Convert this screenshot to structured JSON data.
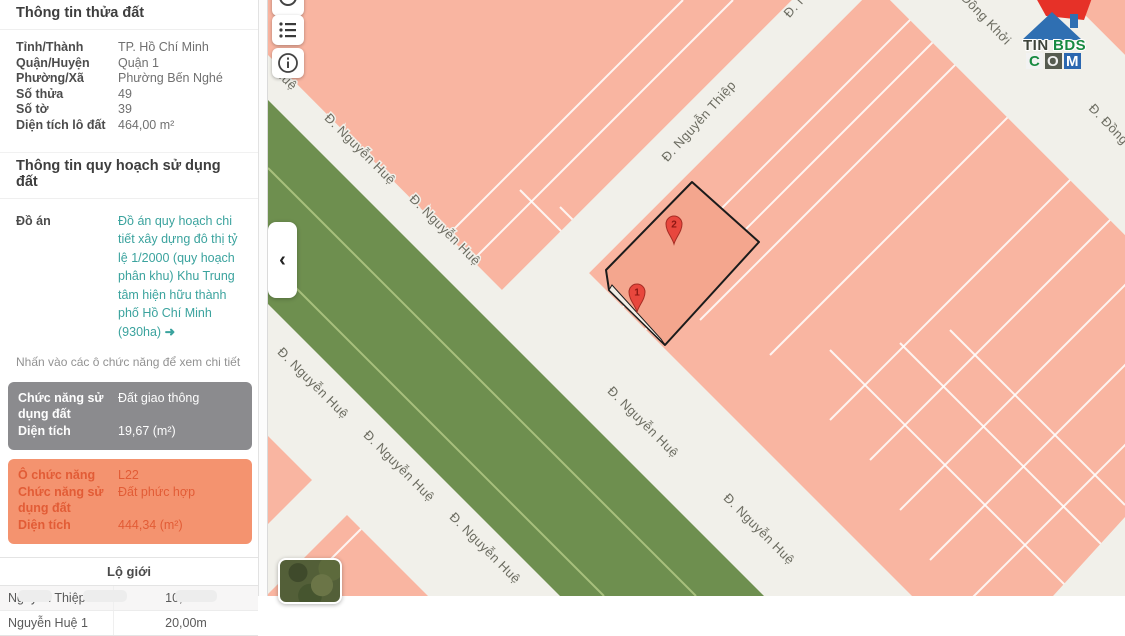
{
  "sidebar": {
    "section1_title": "Thông tin thửa đất",
    "fields": [
      {
        "label": "Tỉnh/Thành",
        "value": "TP. Hồ Chí Minh"
      },
      {
        "label": "Quận/Huyện",
        "value": "Quận 1"
      },
      {
        "label": "Phường/Xã",
        "value": "Phường Bến Nghé"
      },
      {
        "label": "Số thửa",
        "value": "49"
      },
      {
        "label": "Số tờ",
        "value": "39"
      },
      {
        "label": "Diện tích lô đất",
        "value": "464,00 m²"
      }
    ],
    "section2_title": "Thông tin quy hoạch sử dụng đất",
    "do_an_label": "Đồ án",
    "do_an_link": "Đồ án quy hoạch chi tiết xây dựng đô thị tỷ lệ 1/2000 (quy hoạch phân khu) Khu Trung tâm hiện hữu thành phố Hồ Chí Minh (930ha)",
    "do_an_arrow": "➜",
    "note": "Nhấn vào các ô chức năng để xem chi tiết",
    "gray_card": {
      "rows": [
        {
          "label": "Chức năng sử dụng đất",
          "value": "Đất giao thông"
        },
        {
          "label": "Diện tích",
          "value": "19,67 (m²)"
        }
      ]
    },
    "orange_card": {
      "rows": [
        {
          "label": "Ô chức năng",
          "value": "L22"
        },
        {
          "label": "Chức năng sử dụng đất",
          "value": "Đất phức hợp"
        },
        {
          "label": "Diện tích",
          "value": "444,34 (m²)"
        }
      ]
    },
    "road_table": {
      "title": "Lộ giới",
      "rows": [
        {
          "name": "Nguyễn Thiệp",
          "width": "10,00m"
        },
        {
          "name": "Nguyễn Huệ 1",
          "width": "20,00m"
        }
      ]
    }
  },
  "map": {
    "toolbar": [
      {
        "icon": "circle-icon"
      },
      {
        "icon": "list-icon"
      },
      {
        "icon": "info-icon"
      }
    ],
    "collapse_chevron": "‹",
    "labels": [
      {
        "text": "Huệ"
      },
      {
        "text": "Đ. Nguyễn Huệ"
      },
      {
        "text": "Đ. Nguyễn Huệ"
      },
      {
        "text": "Đ. Nguyễn Huệ"
      },
      {
        "text": "Đ. Nguyễn Huệ"
      },
      {
        "text": "Đ. Nguyễn Huệ"
      },
      {
        "text": "Đ. Nguyễn Huệ"
      },
      {
        "text": "Đ. Nguyễn Huệ"
      },
      {
        "text": "Đ. Nguyễn Thiệp"
      },
      {
        "text": "Đ. Nguyễn Thiệp"
      },
      {
        "text": "Đồng Khởi"
      },
      {
        "text": "Đ. Đồng Khởi"
      }
    ],
    "markers": [
      {
        "n": "1"
      },
      {
        "n": "2"
      }
    ],
    "logo": {
      "part1": "TIN",
      "part2": "BDS",
      "c": "C",
      "o": "O",
      "m": "M"
    }
  },
  "colors": {
    "link_teal": "#3ba39e",
    "gray_card_bg": "#8b8b8e",
    "orange_card_bg": "#f4936f",
    "orange_card_text": "#e25c36",
    "map_block_pink": "#f9b5a1",
    "map_parcel_pink": "#f4a68e",
    "map_green": "#6e8f4f",
    "map_street": "#f1f0ea",
    "marker_red": "#e8473d"
  }
}
